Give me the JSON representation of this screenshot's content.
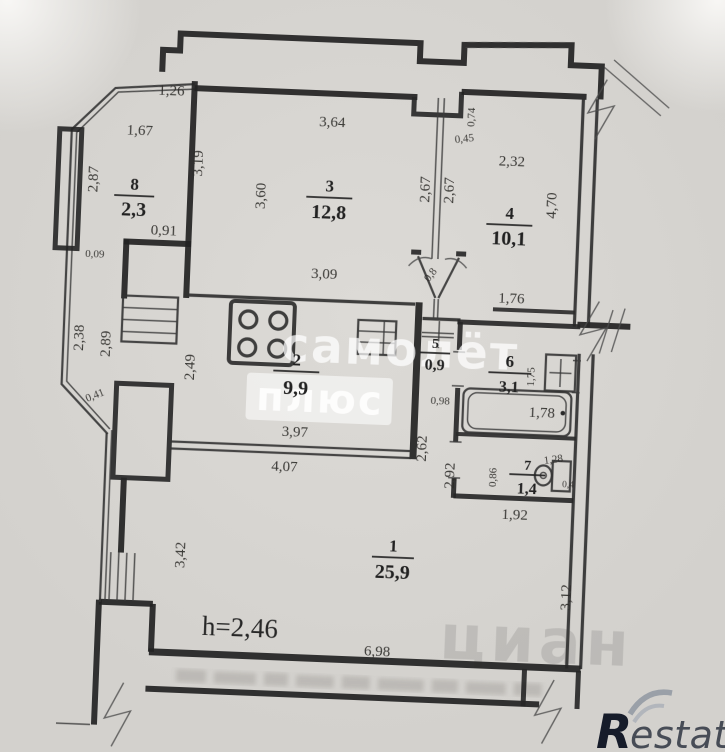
{
  "plan": {
    "labels": {
      "l_1_26": "1,26",
      "l_1_67": "1,67",
      "l_2_87": "2,87",
      "l_3_19": "3,19",
      "l_0_91": "0,91",
      "l_0_09": "0,09",
      "l_3_64": "3,64",
      "l_3_60": "3,60",
      "l_2_67a": "2,67",
      "l_2_67b": "2,67",
      "l_0_45": "0,45",
      "l_0_74": "0,74",
      "l_2_32": "2,32",
      "l_4_70": "4,70",
      "l_3_09": "3,09",
      "l_1_76": "1,76",
      "l_2_38": "2,38",
      "l_2_89": "2,89",
      "l_2_49": "2,49",
      "l_0_41": "0,41",
      "l_3_97": "3,97",
      "l_4_07": "4,07",
      "l_0_98": "0,98",
      "l_2_62": "2,62",
      "l_2_92": "2,92",
      "l_0_86": "0,86",
      "l_1_28": "1,28",
      "l_0_4": "0,4",
      "l_1_92": "1,92",
      "l_1_75": "1,75",
      "l_1_78": "1,78",
      "l_3_42": "3,42",
      "l_6_98": "6,98",
      "l_3_12": "3,12",
      "l_height": "h=2,46",
      "l_0_8": "0,8"
    },
    "rooms": [
      {
        "number": "1",
        "area": "25,9"
      },
      {
        "number": "2",
        "area": "9,9"
      },
      {
        "number": "3",
        "area": "12,8"
      },
      {
        "number": "4",
        "area": "10,1"
      },
      {
        "number": "5",
        "area": "0,9"
      },
      {
        "number": "6",
        "area": "3,1"
      },
      {
        "number": "7",
        "area": "1,4"
      },
      {
        "number": "8",
        "area": "2,3"
      }
    ]
  },
  "watermarks": {
    "samolet": "самолёт",
    "plus": "плюс",
    "cian": "циан",
    "restate_r": "R",
    "restate_rest": "estate"
  }
}
